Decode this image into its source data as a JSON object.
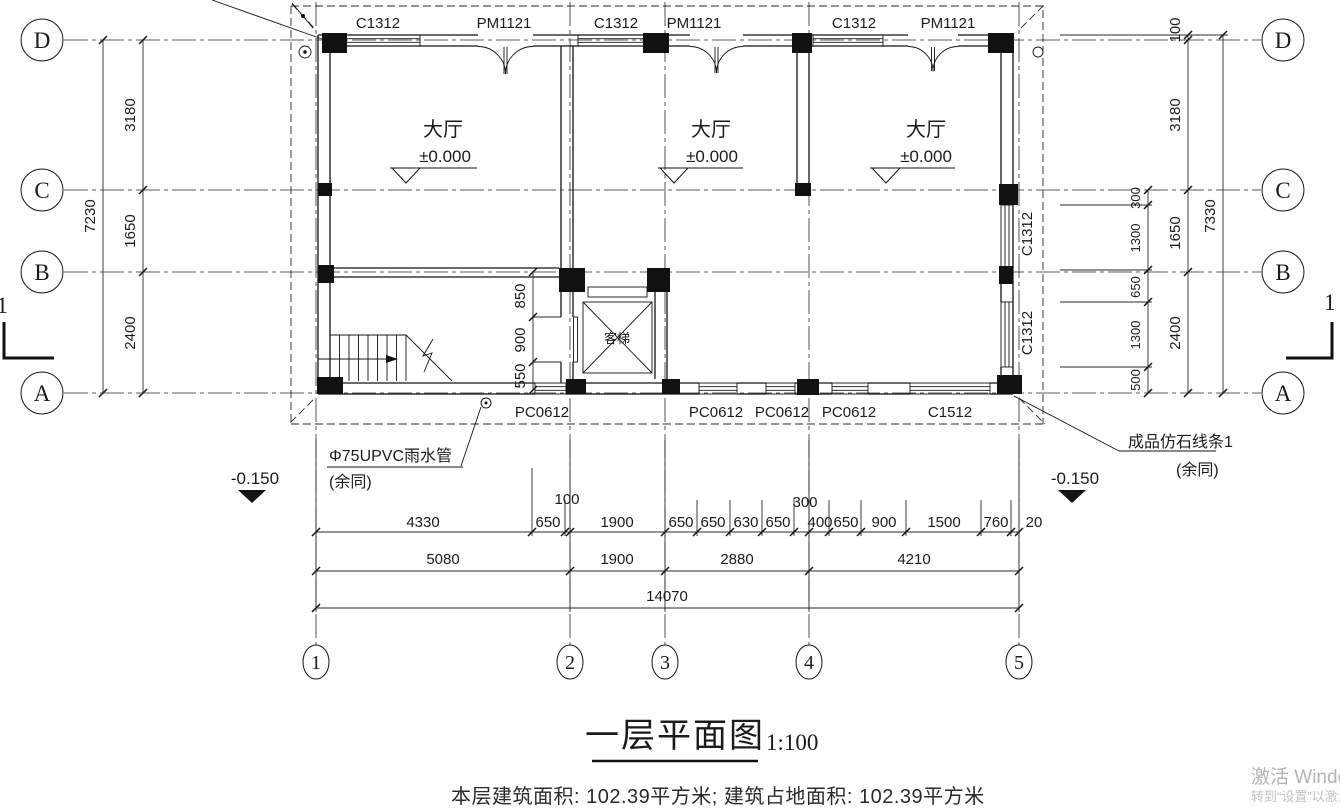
{
  "drawing": {
    "title": "一层平面图",
    "scale": "1:100",
    "footer": "本层建筑面积: 102.39平方米; 建筑占地面积: 102.39平方米"
  },
  "watermark": {
    "line1": "激活 Windows",
    "line2": "转到“设置”以激活 Windows。"
  },
  "grid": {
    "rows": [
      "D",
      "C",
      "B",
      "A"
    ],
    "cols": [
      "1",
      "2",
      "3",
      "4",
      "5"
    ]
  },
  "rooms": {
    "hall": "大厅",
    "hall_level": "±0.000",
    "elevator": "客梯"
  },
  "openings": {
    "top": [
      "C1312",
      "PM1121",
      "C1312",
      "PM1121",
      "C1312",
      "PM1121"
    ],
    "bottom": [
      "PC0612",
      "PC0612",
      "PC0612",
      "PC0612",
      "C1512"
    ],
    "right": [
      "C1312",
      "C1312"
    ]
  },
  "dims": {
    "left": {
      "total": "7230",
      "segs": [
        "3180",
        "1650",
        "2400"
      ]
    },
    "right": {
      "total": "7330",
      "segs": [
        "3180",
        "1650",
        "2400"
      ],
      "inner": [
        "300",
        "1300",
        "650",
        "1300",
        "500"
      ],
      "top": "100"
    },
    "lobby": [
      "850",
      "900",
      "550"
    ],
    "row1": [
      "4330",
      "650",
      "100",
      "1900",
      "650",
      "650",
      "630",
      "650",
      "300",
      "400",
      "650",
      "900",
      "1500",
      "760",
      "20"
    ],
    "row2": [
      "5080",
      "1900",
      "2880",
      "4210"
    ],
    "row3": "14070"
  },
  "annotations": {
    "rain_pipe": "Φ75UPVC雨水管",
    "rain_pipe_note": "(余同)",
    "stone": "成品仿石线条1",
    "stone_note": "(余同)",
    "level": "-0.150",
    "section": "1"
  }
}
